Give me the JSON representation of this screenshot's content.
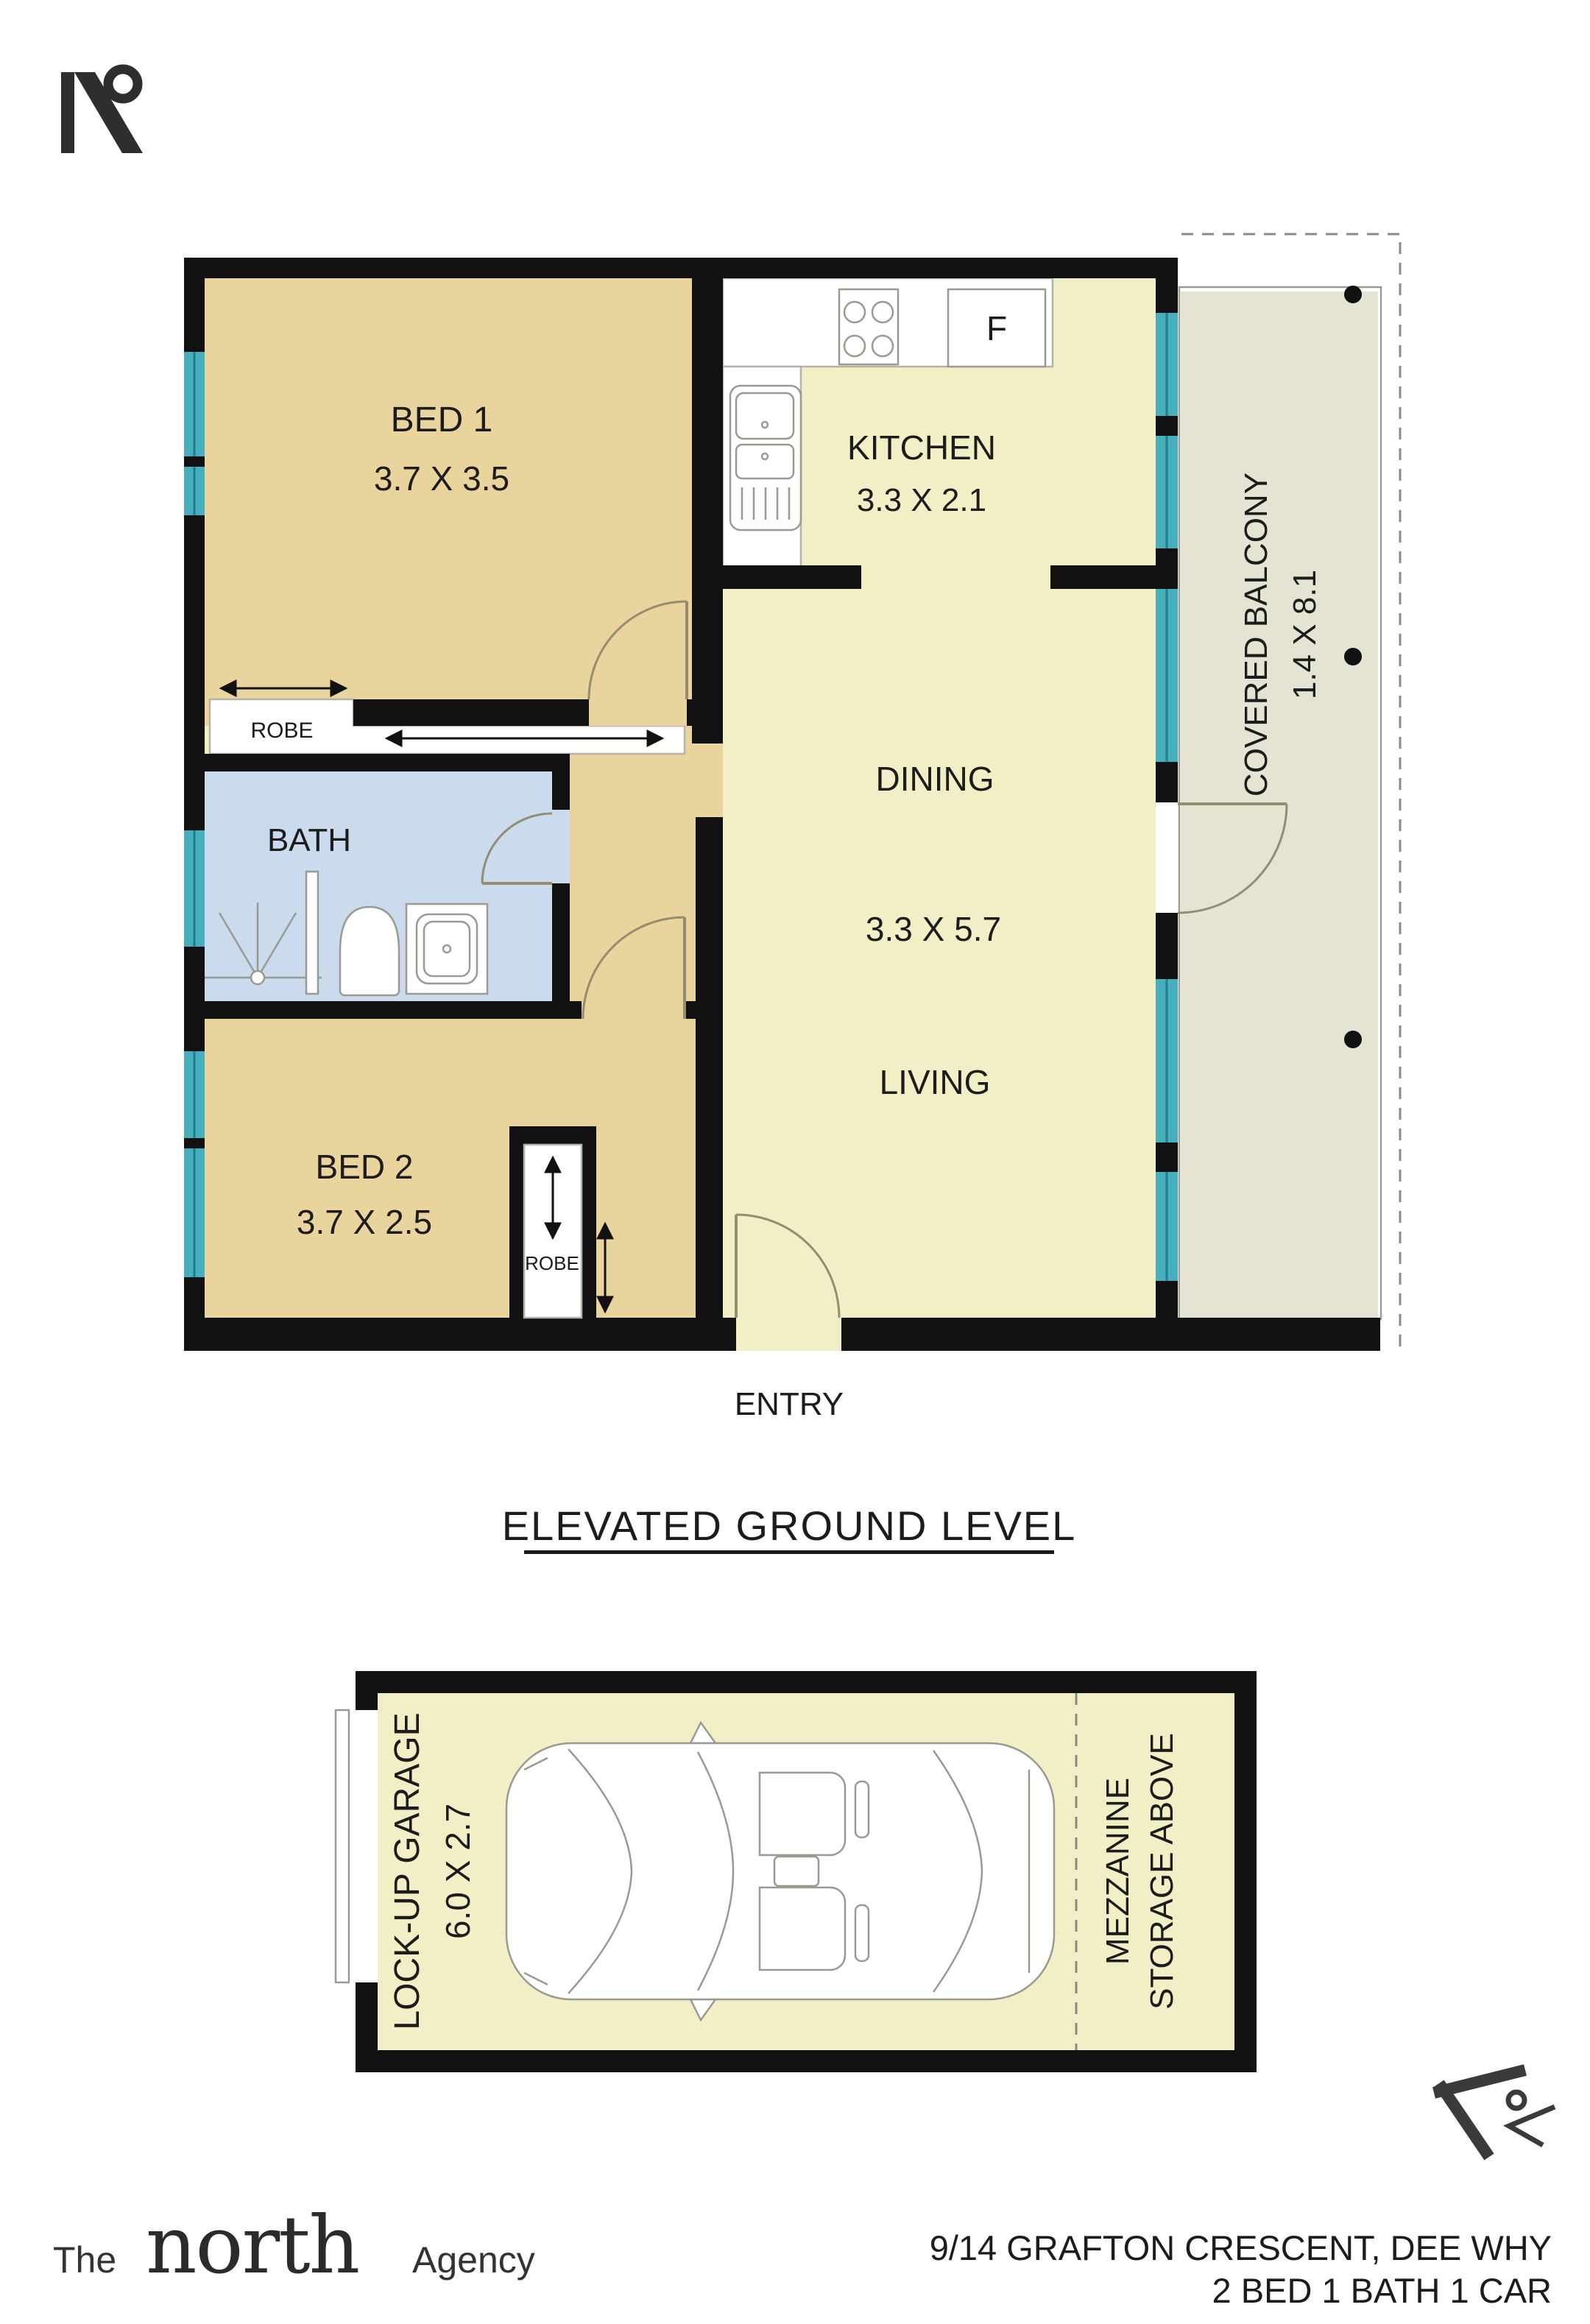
{
  "palette": {
    "wall": "#111111",
    "bedroom_fill": "#ead49e",
    "living_fill": "#f2eec6",
    "bath_fill": "#cbdbee",
    "balcony_fill": "#e5e3d1",
    "window_teal": "#47aebb",
    "text": "#1c1c1c"
  },
  "icons": {
    "top_left": "north-compass",
    "bottom_right": "north-compass-rotated"
  },
  "floor_plan": {
    "level_title": "ELEVATED GROUND LEVEL",
    "rooms": {
      "bed1": {
        "name": "BED 1",
        "dims": "3.7 X 3.5"
      },
      "kitchen": {
        "name": "KITCHEN",
        "dims": "3.3 X 2.1"
      },
      "dining": {
        "name": "DINING",
        "dims": "3.3 X 5.7"
      },
      "living": {
        "name": "LIVING"
      },
      "bath": {
        "name": "BATH"
      },
      "bed2": {
        "name": "BED 2",
        "dims": "3.7 X 2.5"
      },
      "balcony": {
        "name": "COVERED BALCONY",
        "dims": "1.4 X 8.1"
      }
    },
    "labels": {
      "robe_bed1": "ROBE",
      "robe_bed2": "ROBE",
      "entry": "ENTRY",
      "fridge": "F"
    }
  },
  "garage_plan": {
    "name": "LOCK-UP GARAGE",
    "dims": "6.0 X 2.7",
    "mezzanine_line1": "MEZZANINE",
    "mezzanine_line2": "STORAGE ABOVE"
  },
  "footer": {
    "brand": {
      "prefix": "The",
      "name": "north",
      "suffix": "Agency"
    },
    "address": "9/14 GRAFTON CRESCENT, DEE WHY",
    "property_summary": "2 BED 1 BATH 1 CAR"
  }
}
